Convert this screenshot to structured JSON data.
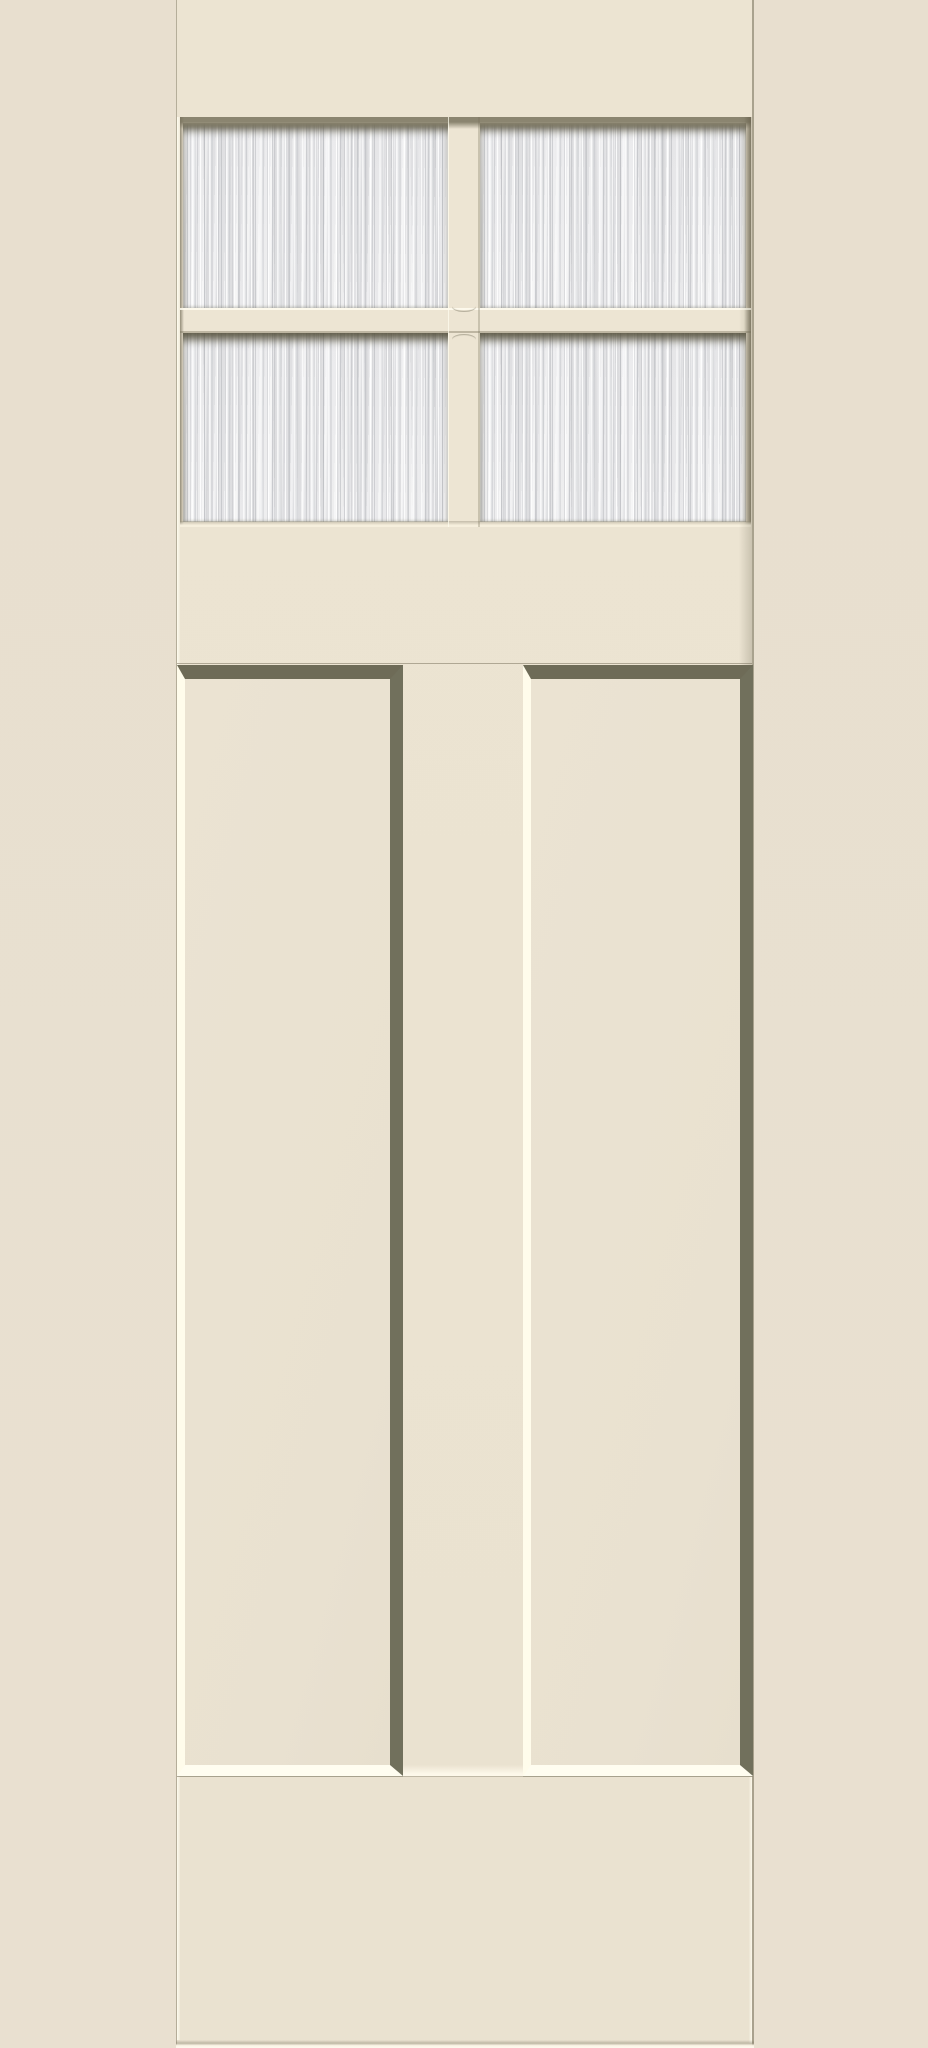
{
  "scene": {
    "type": "product-photo",
    "subject": "Smooth craftsman-style door slab, painted cream, with a 2x2 grid of obscure rain-glass lites at the top and two tall vertical recessed panels below",
    "text_content": "none",
    "door": {
      "lite_rows": 2,
      "lite_cols": 2,
      "lite_count": 4,
      "panel_count": 2,
      "glass_texture": "vertical rain / reed glass streaks",
      "parts": [
        "top-rail",
        "glass-grid",
        "lite-top-left",
        "lite-top-right",
        "lite-bottom-left",
        "lite-bottom-right",
        "muntin-vertical-bar",
        "muntin-horizontal-bar",
        "lock-rail",
        "panel-left",
        "panel-right",
        "center-stile",
        "bottom-rail"
      ]
    },
    "colors": {
      "background": "#e8dfcf",
      "door-face": "#ece4d2",
      "muntin": "#ede5d3",
      "bevel-shadow": "#6e6b57",
      "bevel-shadow-2": "#71705c",
      "bevel-highlight": "#fffdf0",
      "bevel-highlight-2": "#fffceb",
      "glass-base": "#e6e6e8",
      "glass-base-2": "#e9e9eb",
      "glass-streak-dark": "#b0b2b7",
      "glass-streak-light": "#ffffff",
      "glass-top-band": "#8b8570",
      "edge-hairline": "#8e8871"
    }
  }
}
